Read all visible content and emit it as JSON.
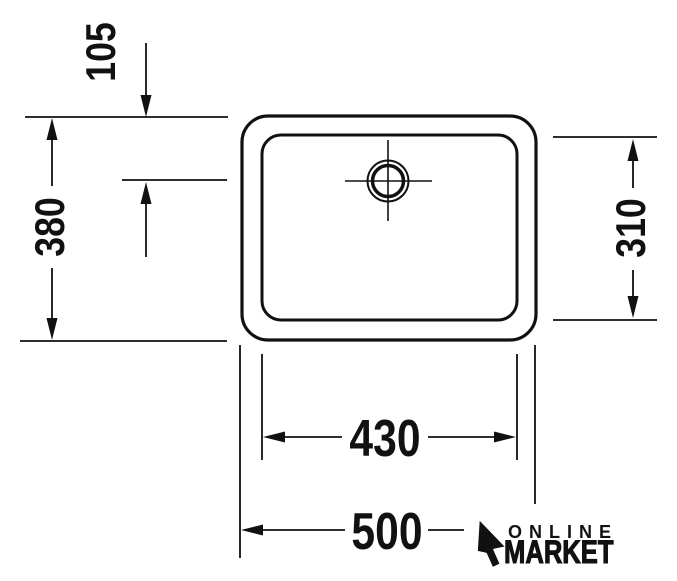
{
  "drawing": {
    "type": "sink-basin-plan-view-technical-drawing",
    "units": "mm",
    "line_color": "#111111",
    "background_color": "#ffffff",
    "dimensions": {
      "drain_offset_top": "105",
      "outer_depth": "380",
      "inner_depth": "310",
      "inner_width": "430",
      "outer_width": "500"
    }
  },
  "logo": {
    "line1": "ONLINE",
    "line2": "MARKET",
    "icon": "cursor-arrow-icon"
  }
}
